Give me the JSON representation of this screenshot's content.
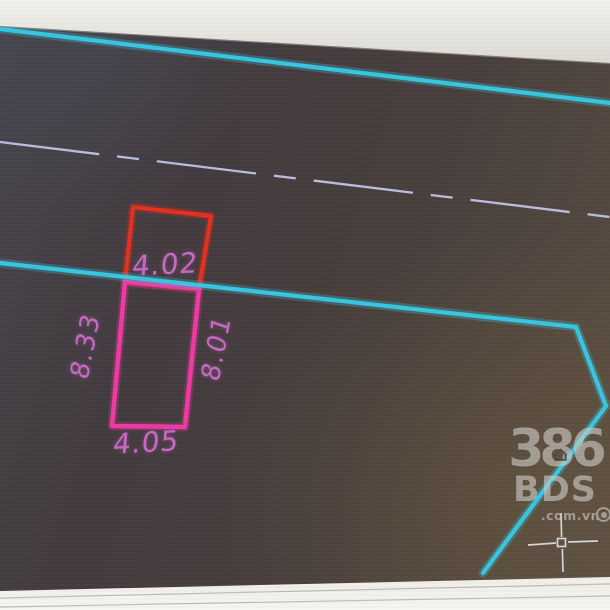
{
  "drawing": {
    "plot": {
      "width_top": "4.02",
      "depth_left": "8.33",
      "depth_right": "8.01",
      "width_bottom": "4.05"
    }
  },
  "watermark": {
    "number": "386",
    "name": "BDS",
    "domain": ".com.vn"
  },
  "colors": {
    "boundary-cyan": "#38c6e0",
    "plot-red": "#e5301f",
    "plot-magenta": "#ee3aa2",
    "dimension-text": "#c869c4",
    "centerline": "#c6c8ec",
    "crosshair": "#e3e3e8"
  }
}
